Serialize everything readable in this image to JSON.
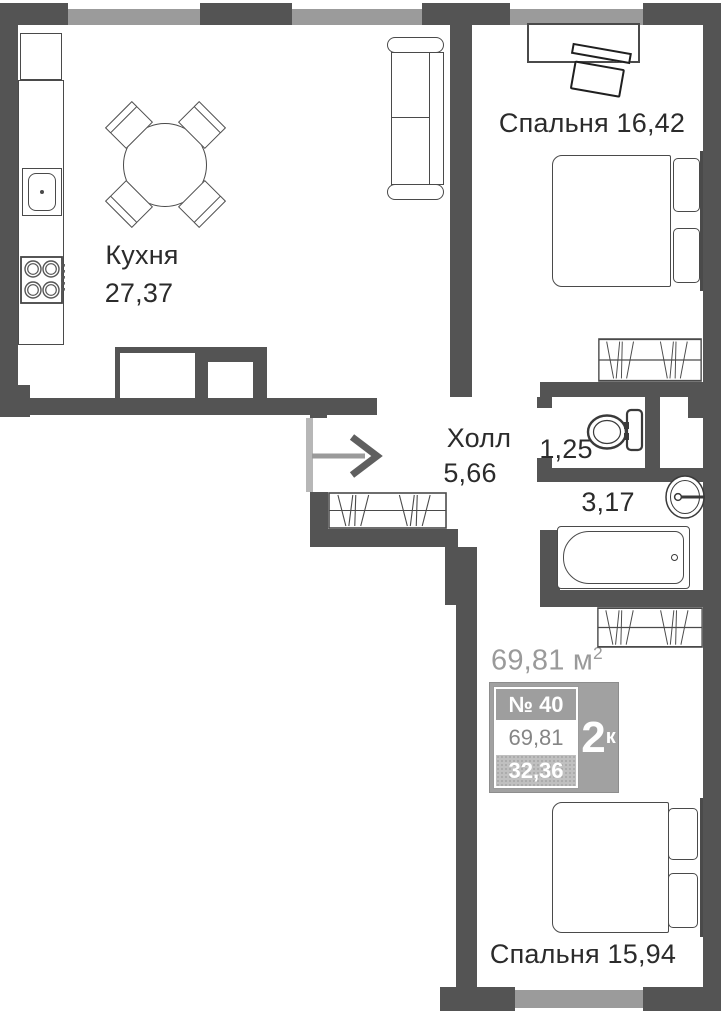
{
  "plan": {
    "rooms": [
      {
        "name": "Кухня",
        "area": "27,37"
      },
      {
        "name": "Спальня",
        "area": "16,42"
      },
      {
        "name": "Холл",
        "area": "5,66"
      },
      {
        "name": "",
        "area": "1,25"
      },
      {
        "name": "",
        "area": "3,17"
      },
      {
        "name": "Спальня",
        "area": "15,94"
      }
    ],
    "total": {
      "value": "69,81",
      "unit": "м",
      "sup": "2"
    },
    "badge": {
      "number": "№ 40",
      "total": "69,81",
      "living": "32,36",
      "rooms_count": "2",
      "rooms_suffix": "к"
    },
    "colors": {
      "wall": "#545454",
      "window": "#9b9b9b",
      "badge": "#a1a1a1",
      "text": "#2b2b2b",
      "muted": "#9a9a9a"
    }
  }
}
